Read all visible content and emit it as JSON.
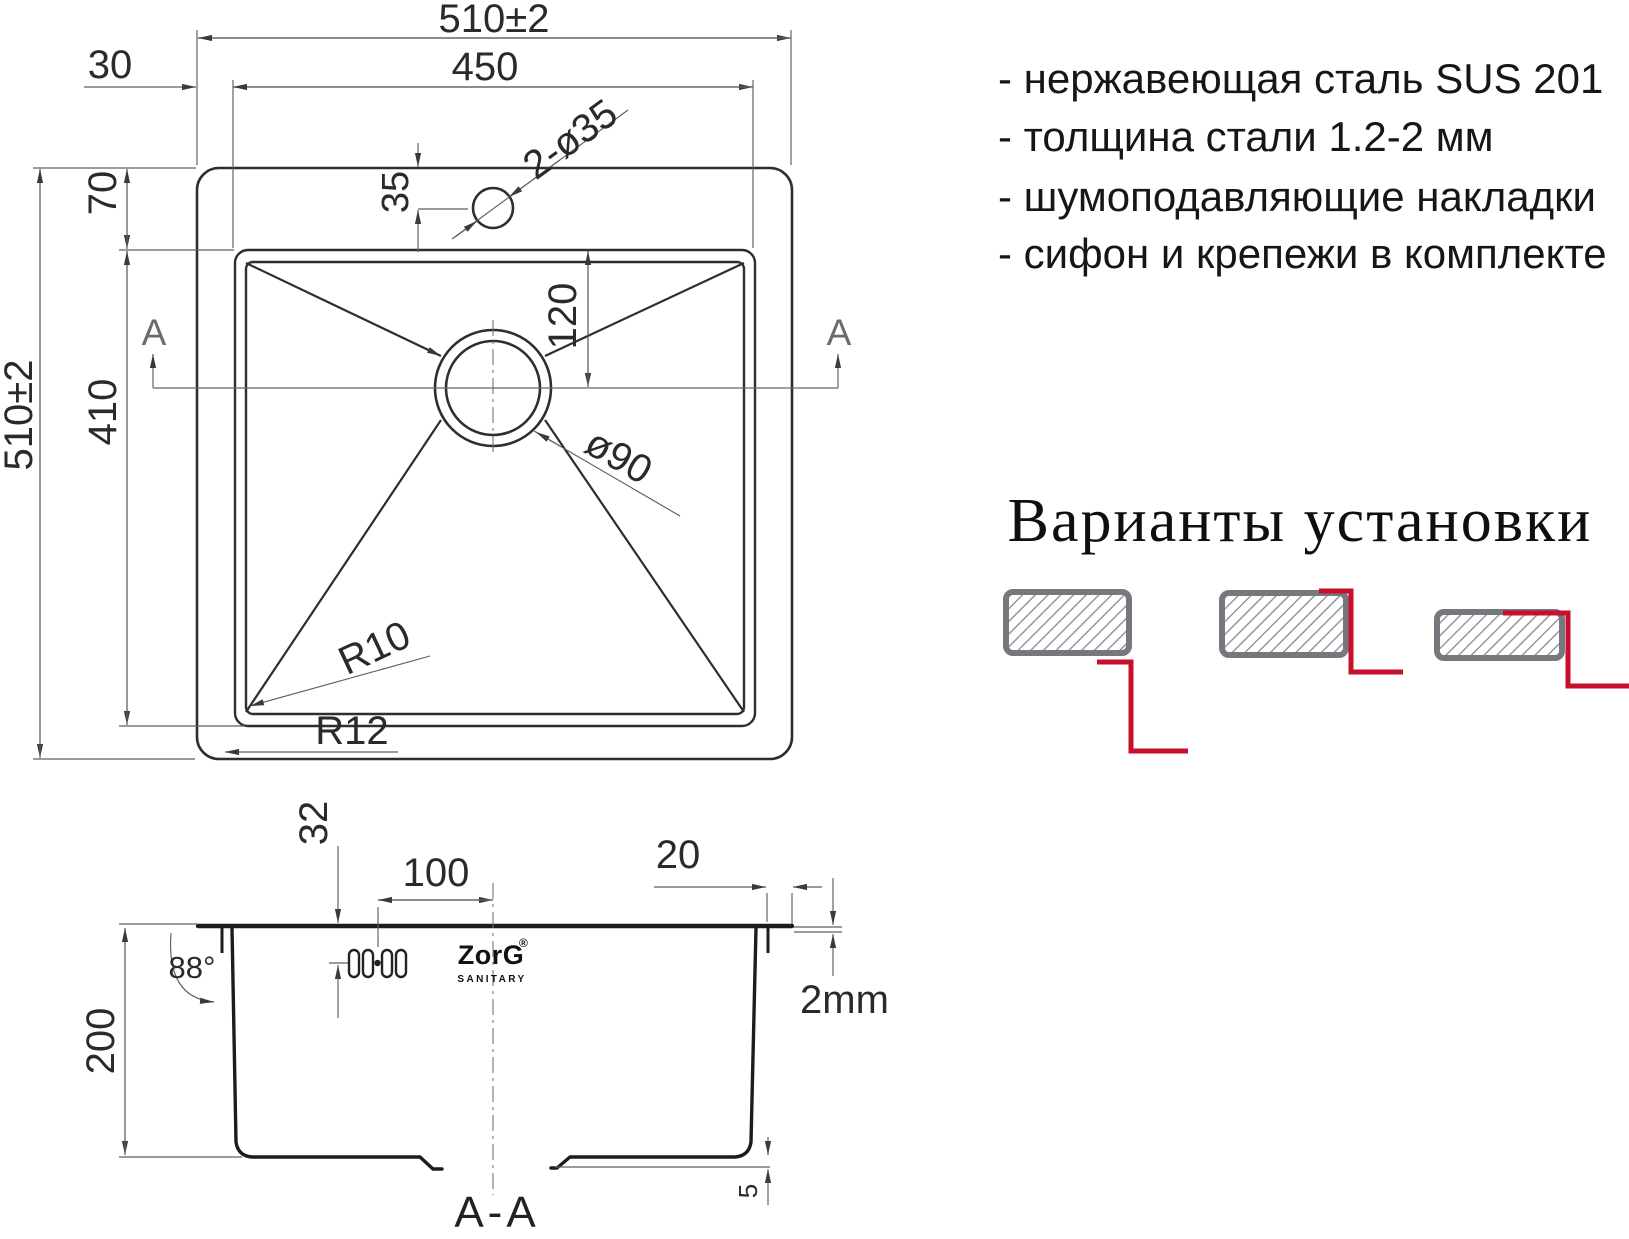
{
  "features": {
    "items": [
      "- нержавеющая сталь SUS 201",
      "- толщина стали 1.2-2 мм",
      "- шумоподавляющие накладки",
      "- сифон и крепежи в комплекте"
    ]
  },
  "installation": {
    "title": "Варианты установки",
    "variants": [
      "undermount",
      "flush-mount",
      "overmount"
    ]
  },
  "top_view": {
    "width_overall": "510±2",
    "width_bowl": "450",
    "edge_offset": "30",
    "top_offset": "70",
    "height_overall": "510±2",
    "height_bowl": "410",
    "faucet_offset": "35",
    "faucet_holes": "2-ø35",
    "drain_offset": "120",
    "drain_diameter": "ø90",
    "corner_radius_inner": "R10",
    "corner_radius_outer": "R12",
    "section_letter": "A"
  },
  "section_view": {
    "title": "A-A",
    "depth": "200",
    "rim_to_holes": "32",
    "holes_to_center": "100",
    "flange_width": "20",
    "wall_angle": "88°",
    "steel_thickness": "2mm",
    "bottom_step": "5",
    "logo": "ZorG",
    "logo_mark": "®",
    "logo_subtitle": "SANITARY"
  },
  "colors": {
    "accent_red": "#c8102e",
    "counter_gray": "#75797e",
    "hatch_gray": "#8d9297",
    "line_dark": "#2e2e2e"
  }
}
